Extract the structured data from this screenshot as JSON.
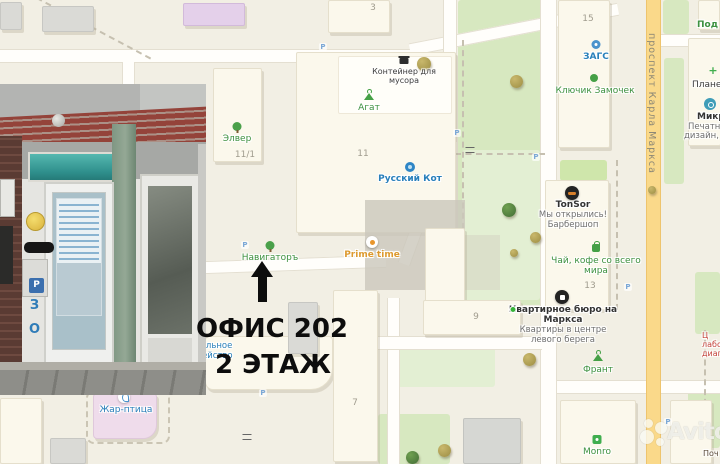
{
  "colors": {
    "poi_green": "#3d9140",
    "poi_blue": "#2980bb",
    "poi_orange": "#dd9a2f",
    "poi_red": "#c4423a",
    "road_yellow": "#fad98a",
    "annotation_text": "#0d0d0d"
  },
  "annotation": {
    "line1": "ОФИС 202",
    "line2": "2 ЭТАЖ"
  },
  "watermark": {
    "brand": "Avito"
  },
  "street_labels": {
    "karla_marksa": "проспект Карла Маркса"
  },
  "building_numbers": {
    "b3": "3",
    "b11": "11",
    "b11_1": "11/1",
    "b15": "15",
    "b13": "13",
    "b9": "9",
    "b7": "7"
  },
  "photo_overlay": {
    "door_letters": "ВЗО"
  },
  "poi": {
    "elver": {
      "label": "Элвер"
    },
    "agat": {
      "label": "Агат"
    },
    "navigator": {
      "label": "Навигаторъ"
    },
    "container": {
      "line1": "Контейнер для",
      "line2": "мусора"
    },
    "russkiy_kot": {
      "label": "Русский Кот"
    },
    "prime_time": {
      "label": "Prime time"
    },
    "zags": {
      "label": "ЗАГС"
    },
    "klyuchik": {
      "label": "Ключик Замочек"
    },
    "pod_k": {
      "label": "Под к"
    },
    "planeta": {
      "label": "Планета"
    },
    "mikro": {
      "title": "Микро",
      "line1": "Печатные у",
      "line2": "дизайн, фот"
    },
    "tonsor": {
      "title": "TonSor",
      "line1": "Мы открылись!",
      "line2": "Барбершоп"
    },
    "tea": {
      "line1": "Чай, кофе со всего",
      "line2": "мира"
    },
    "kvartirnoe": {
      "title1": "Квартирное бюро на",
      "title2": "Маркса",
      "sub1": "Квартиры в центре",
      "sub2": "левого берега"
    },
    "frant": {
      "label": "Франт"
    },
    "monro": {
      "label": "Monro"
    },
    "zhar_ptitsa": {
      "label": "Жар-птица"
    },
    "kaznacheystvo": {
      "line1": "Федеральное",
      "line2": "казначейство"
    },
    "lab": {
      "line1": "Ц",
      "line2": "лабор",
      "line3": "диагн"
    },
    "pochta": {
      "label": "Поч"
    }
  }
}
